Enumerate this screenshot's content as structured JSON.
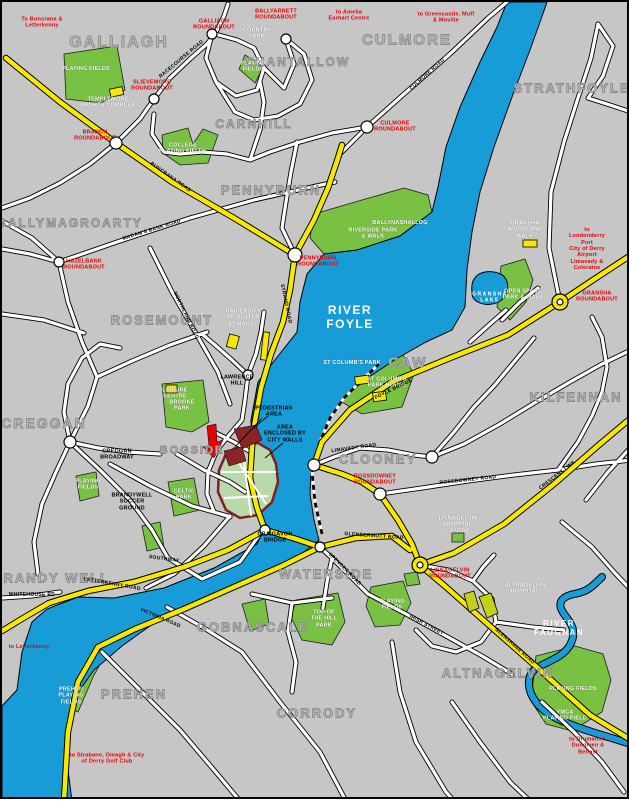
{
  "map": {
    "colors": {
      "background": "#c6c6c6",
      "river": "#189cd8",
      "park_green": "#79c142",
      "minor_road": "#ffffff",
      "major_road_yellow": "#f6e800",
      "walled_area_green": "#b9d9ab",
      "city_wall_maroon": "#7a2125",
      "pedestrian_area_maroon": "#8a2426",
      "red_label": "#e60000",
      "district_gray": "#9a9a9a"
    },
    "labels": [
      {
        "name": "district-galliagh",
        "type": "district",
        "text": "GALLIAGH",
        "x": 117,
        "y": 41,
        "size": 16
      },
      {
        "name": "district-shantallow",
        "type": "district",
        "text": "SHANTALLOW",
        "x": 296,
        "y": 60,
        "size": 12
      },
      {
        "name": "district-culmore",
        "type": "district",
        "text": "CULMORE",
        "x": 405,
        "y": 38,
        "size": 15
      },
      {
        "name": "district-strathfoyle",
        "type": "district",
        "text": "STRATHFOYLE",
        "x": 570,
        "y": 86,
        "size": 13
      },
      {
        "name": "district-carnhill",
        "type": "district",
        "text": "CARNHILL",
        "x": 252,
        "y": 122,
        "size": 12
      },
      {
        "name": "district-pennyburn",
        "type": "district",
        "text": "PENNYBURN",
        "x": 269,
        "y": 188,
        "size": 13
      },
      {
        "name": "district-ballymagroarty",
        "type": "district",
        "text": "BALLYMAGROARTY",
        "x": 68,
        "y": 221,
        "size": 12
      },
      {
        "name": "district-rosemount",
        "type": "district",
        "text": "ROSEMOUNT",
        "x": 160,
        "y": 318,
        "size": 13
      },
      {
        "name": "district-creggan",
        "type": "district",
        "text": "CREGGAN",
        "x": 42,
        "y": 421,
        "size": 14
      },
      {
        "name": "district-bogside",
        "type": "district",
        "text": "BOGSIDE",
        "x": 190,
        "y": 449,
        "size": 11
      },
      {
        "name": "district-caw",
        "type": "district",
        "text": "CAW",
        "x": 406,
        "y": 360,
        "size": 14
      },
      {
        "name": "district-kilfennan",
        "type": "district",
        "text": "KILFENNAN",
        "x": 574,
        "y": 395,
        "size": 13
      },
      {
        "name": "district-clooney",
        "type": "district",
        "text": "CLOONEY",
        "x": 376,
        "y": 457,
        "size": 13
      },
      {
        "name": "district-brandy-well",
        "type": "district",
        "text": "BRANDY WELL",
        "x": 49,
        "y": 576,
        "size": 13
      },
      {
        "name": "district-waterside",
        "type": "district",
        "text": "WATERSIDE",
        "x": 324,
        "y": 572,
        "size": 13
      },
      {
        "name": "district-gobnascale",
        "type": "district",
        "text": "GOBNASCALE",
        "x": 251,
        "y": 625,
        "size": 13
      },
      {
        "name": "district-prehen",
        "type": "district",
        "text": "PREHEN",
        "x": 132,
        "y": 692,
        "size": 13
      },
      {
        "name": "district-corrody",
        "type": "district",
        "text": "CORRODY",
        "x": 315,
        "y": 711,
        "size": 13
      },
      {
        "name": "district-altnagelvin",
        "type": "district",
        "text": "ALTNAGELVIN",
        "x": 496,
        "y": 671,
        "size": 13
      },
      {
        "name": "water-label-river-foyle",
        "type": "water",
        "text": "RIVER\nFOYLE",
        "x": 348,
        "y": 316,
        "size": 12
      },
      {
        "name": "water-label-river-faughan",
        "type": "water",
        "text": "RIVER\nFAUGHAN",
        "x": 557,
        "y": 626,
        "size": 8
      },
      {
        "name": "water-label-gransha-lake",
        "type": "water",
        "text": "GRANSHA\nLAKE",
        "x": 488,
        "y": 296,
        "size": 5
      },
      {
        "name": "roundabout-label-galliagh",
        "type": "red",
        "text": "GALLIAGH\nROUNDABOUT",
        "x": 212,
        "y": 23
      },
      {
        "name": "roundabout-label-ballyarnett",
        "type": "red",
        "text": "BALLYARNETT\nROUNDABOUT",
        "x": 274,
        "y": 13
      },
      {
        "name": "roundabout-label-slievemore",
        "type": "red",
        "text": "SLIEVEMORE\nROUNDABOUT",
        "x": 150,
        "y": 84
      },
      {
        "name": "roundabout-label-branch",
        "type": "red",
        "text": "BRANCH\nROUNDABOUT",
        "x": 93,
        "y": 134
      },
      {
        "name": "roundabout-label-culmore",
        "type": "red",
        "text": "CULMORE\nROUNDABOUT",
        "x": 393,
        "y": 125
      },
      {
        "name": "roundabout-label-hazelbank",
        "type": "red",
        "text": "HAZELBANK\nROUNDABOUT",
        "x": 82,
        "y": 263
      },
      {
        "name": "roundabout-label-pennyburn",
        "type": "red",
        "text": "PENNYBURN\nROUNDABOUT",
        "x": 316,
        "y": 260
      },
      {
        "name": "roundabout-label-gransha",
        "type": "red",
        "text": "GRANSHA\nROUNDABOUT",
        "x": 595,
        "y": 295
      },
      {
        "name": "roundabout-label-rossdowney",
        "type": "red",
        "text": "ROSSDOWNEY\nROUNDABOUT",
        "x": 373,
        "y": 478
      },
      {
        "name": "roundabout-label-lisnagelvin",
        "type": "red",
        "text": "LISNAGELVIN\nROUNDABOUT",
        "x": 448,
        "y": 572
      },
      {
        "name": "direction-label-buncrana",
        "type": "red",
        "text": "To Buncrana &\nLetterkenny",
        "x": 40,
        "y": 21
      },
      {
        "name": "direction-label-amelia-earhart",
        "type": "red",
        "text": "to Amelia\nEarhart Centre",
        "x": 347,
        "y": 14
      },
      {
        "name": "direction-label-greencastle",
        "type": "red",
        "text": "to Greencastle, Muff\n& Moville",
        "x": 444,
        "y": 16
      },
      {
        "name": "direction-label-londonderry-port",
        "type": "red",
        "text": "to Londonderry Port\nCity of Derry Airport\nLimavady & Coleraine",
        "x": 585,
        "y": 247
      },
      {
        "name": "direction-label-letterkenny",
        "type": "red",
        "text": "to Letterkenny",
        "x": 27,
        "y": 645
      },
      {
        "name": "direction-label-strabane",
        "type": "red",
        "text": "to Strabane, Omagh & City\nof Derry Golf Club",
        "x": 105,
        "y": 757
      },
      {
        "name": "direction-label-drumahoe",
        "type": "red",
        "text": "to Drumahoe,\nDungiven & Belfast",
        "x": 586,
        "y": 744
      },
      {
        "name": "park-label-galliagh-playing-fields",
        "type": "park",
        "text": "PLAYING FIELDS",
        "x": 84,
        "y": 67
      },
      {
        "name": "poi-label-templemore-sports-complex",
        "type": "park",
        "text": "TEMPLEMORE\nSPORTS COMPLEX",
        "x": 106,
        "y": 101
      },
      {
        "name": "park-label-country-park",
        "type": "park",
        "text": "COUNTRY\nPARK",
        "x": 255,
        "y": 32
      },
      {
        "name": "park-label-ballyarnett-playing-fields",
        "type": "park",
        "text": "PLAYING\nFIELDS",
        "x": 251,
        "y": 65
      },
      {
        "name": "park-label-college-playing-fields",
        "type": "park",
        "text": "COLLEGE\nPLAYING FIELDS",
        "x": 181,
        "y": 147
      },
      {
        "name": "park-label-ballynashallog",
        "type": "park",
        "text": "BALLYNASHALLOG",
        "x": 398,
        "y": 221
      },
      {
        "name": "park-label-riverside-park",
        "type": "park",
        "text": "RIVERSIDE PARK\n& WALK",
        "x": 371,
        "y": 232
      },
      {
        "name": "poi-label-gransha-woodland-walk",
        "type": "park",
        "text": "GRANSHA\nWOODLAND\nWALK",
        "x": 523,
        "y": 228
      },
      {
        "name": "park-label-open-space-park-walk",
        "type": "park",
        "text": "OPEN SPACE\nPARK & WALK",
        "x": 521,
        "y": 293
      },
      {
        "name": "park-label-st-columbs-park",
        "type": "park",
        "text": "ST COLUMB'S PARK",
        "x": 350,
        "y": 361
      },
      {
        "name": "poi-label-st-columbs-park-house",
        "type": "park",
        "text": "ST COLUMB'S\nPARK HOUSE",
        "x": 385,
        "y": 381
      },
      {
        "name": "poi-label-university-of-ulster",
        "type": "park",
        "text": "UNIVERSITY\nOF ULSTER\nAT MAGEE",
        "x": 241,
        "y": 316
      },
      {
        "name": "poi-label-leisure-centre",
        "type": "park",
        "text": "LEISURE\nCENTRE",
        "x": 173,
        "y": 392
      },
      {
        "name": "park-label-brooke-park",
        "type": "park",
        "text": "BROOKE\nPARK",
        "x": 180,
        "y": 404
      },
      {
        "name": "park-label-celtic-park",
        "type": "park",
        "text": "CELTIC\nPARK",
        "x": 182,
        "y": 493
      },
      {
        "name": "park-label-creggan-playing-fields",
        "type": "park",
        "text": "PLAYING\nFIELDS",
        "x": 86,
        "y": 483
      },
      {
        "name": "park-label-top-of-the-hill-park",
        "type": "park",
        "text": "TOP OF\nTHE HILL\nPARK",
        "x": 322,
        "y": 617
      },
      {
        "name": "park-label-waterside-playing-fields",
        "type": "park",
        "text": "PLAYING\nFIELDS",
        "x": 390,
        "y": 603
      },
      {
        "name": "poi-label-lisnagelvin-shopping-centre",
        "type": "park",
        "text": "LISNAGELVIN\nSHOPPING\nCENTRE",
        "x": 456,
        "y": 523
      },
      {
        "name": "poi-label-altnagelvin-hospital",
        "type": "park",
        "text": "ALTNAGELVIN\nHOSPITAL",
        "x": 523,
        "y": 587
      },
      {
        "name": "park-label-kilfennan-playing-fields",
        "type": "park",
        "text": "PLAYING FIELDS",
        "x": 571,
        "y": 687
      },
      {
        "name": "park-label-ymca-playing-field",
        "type": "park",
        "text": "YMCA\nPLAYING FIELD",
        "x": 563,
        "y": 714
      },
      {
        "name": "park-label-prehen-playing-fields",
        "type": "park",
        "text": "PREHEN\nPLAYING\nFIELDS",
        "x": 69,
        "y": 694
      },
      {
        "name": "note-label-pedestrian-area",
        "type": "black",
        "text": "PEDESTRIAN\nAREA",
        "x": 272,
        "y": 410
      },
      {
        "name": "note-label-city-walls",
        "type": "black",
        "text": "AREA\nENCLOSED BY\nCITY WALLS",
        "x": 283,
        "y": 432
      },
      {
        "name": "poi-label-creggan-broadway",
        "type": "black",
        "text": "CREGGAN\nBROADWAY",
        "x": 115,
        "y": 453
      },
      {
        "name": "poi-label-brandywell-soccer-ground",
        "type": "black",
        "text": "BRANDYWELL\nSOCCER\nGROUND",
        "x": 130,
        "y": 500
      },
      {
        "name": "poi-label-lawrence-hill",
        "type": "black",
        "text": "LAWRENCE\nHILL",
        "x": 235,
        "y": 379
      },
      {
        "name": "poi-label-craigavon-bridge",
        "type": "black",
        "text": "CRAIGAVON\nBRIDGE",
        "x": 273,
        "y": 536
      },
      {
        "name": "road-label-buncrana-road",
        "type": "roadname",
        "text": "BUNCRANA ROAD",
        "x": 168,
        "y": 176,
        "rotate": 35
      },
      {
        "name": "road-label-racecourse-road",
        "type": "roadname",
        "text": "RACECOURSE ROAD",
        "x": 180,
        "y": 58,
        "rotate": -40
      },
      {
        "name": "road-label-culmore-road",
        "type": "roadname",
        "text": "CULMORE ROAD",
        "x": 426,
        "y": 73,
        "rotate": -42
      },
      {
        "name": "road-label-madams-bank-road",
        "type": "roadname",
        "text": "MADAM'S BANK ROAD",
        "x": 150,
        "y": 229,
        "rotate": -17
      },
      {
        "name": "road-label-strand-road",
        "type": "roadname",
        "text": "STRAND ROAD",
        "x": 283,
        "y": 302,
        "rotate": 78
      },
      {
        "name": "road-label-northland-road",
        "type": "roadname",
        "text": "NORTHLAND ROAD",
        "x": 183,
        "y": 314,
        "rotate": 64
      },
      {
        "name": "road-label-foyle-bridge",
        "type": "roadname",
        "text": "FOYLE BRIDGE",
        "x": 392,
        "y": 388,
        "rotate": -26
      },
      {
        "name": "road-label-crescent-link",
        "type": "roadname",
        "text": "CRESCENT LINK",
        "x": 556,
        "y": 474,
        "rotate": -38
      },
      {
        "name": "road-label-glendermott-road",
        "type": "roadname",
        "text": "GLENDERMOTT ROAD",
        "x": 372,
        "y": 535,
        "rotate": 4
      },
      {
        "name": "road-label-victoria-road",
        "type": "roadname",
        "text": "VICTORIA ROAD",
        "x": 158,
        "y": 617,
        "rotate": 23
      },
      {
        "name": "road-label-letterkenny-road",
        "type": "roadname",
        "text": "LETTERKENNY ROAD",
        "x": 110,
        "y": 583,
        "rotate": 10
      },
      {
        "name": "road-label-glenshane-road",
        "type": "roadname",
        "text": "GLENSHANE ROAD",
        "x": 512,
        "y": 645,
        "rotate": 42
      },
      {
        "name": "road-label-limavady-road",
        "type": "roadname",
        "text": "LIMAVADY ROAD",
        "x": 352,
        "y": 447,
        "rotate": -8
      },
      {
        "name": "road-label-rossdowney-road",
        "type": "roadname",
        "text": "ROSSDOWNEY ROAD",
        "x": 466,
        "y": 479,
        "rotate": -6
      },
      {
        "name": "road-label-whitehouse-road",
        "type": "roadname",
        "text": "WHITEHOUSE RD",
        "x": 30,
        "y": 594,
        "rot ate": 0
      },
      {
        "name": "road-label-southway",
        "type": "roadname",
        "text": "SOUTHWAY",
        "x": 162,
        "y": 558,
        "rotate": 8
      },
      {
        "name": "road-label-spencer-road",
        "type": "roadname",
        "text": "SPENCER ROAD",
        "x": 342,
        "y": 568,
        "rotate": 45
      },
      {
        "name": "road-label-irish-street",
        "type": "roadname",
        "text": "IRISH STREET",
        "x": 424,
        "y": 624,
        "rotate": 28
      }
    ]
  }
}
